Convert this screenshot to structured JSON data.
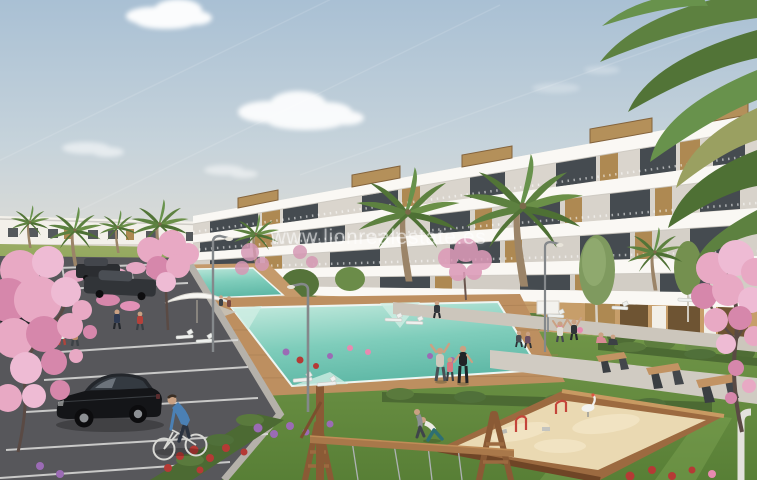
{
  "watermark": {
    "text": "www.lionrealestate.es"
  },
  "scene": {
    "alt": "Architectural render of a modern white terraced apartment complex with wood accents, palm trees, turquoise swimming pools with sun loungers and a parasol, lawns with people exercising, a parking lot with a black hatchback and a cyclist, pink blossoming trees, a wooden sandbox playground and a swing frame."
  },
  "palette": {
    "sky_top": "#a9c0d4",
    "sky_mid": "#c6d3db",
    "sky_horizon": "#e8e0d4",
    "cloud_white": "#ffffff",
    "building_white": "#e9e5dd",
    "slab_white": "#faf8f4",
    "glass_dark": "#454b50",
    "wood_accent": "#ae8952",
    "stucco_tan": "#c79e6a",
    "palm_green": "#5d8140",
    "tree_green": "#6b8c49",
    "lawn_light": "#9aac64",
    "lawn_green": "#6f9447",
    "lawn_dark": "#587f36",
    "hedge_green": "#4c6a33",
    "pool_light": "#c8ece0",
    "pool_turquoise": "#7fcdbb",
    "pool_deep": "#5fb8a6",
    "deck_wood": "#bd8f60",
    "path_grey": "#d0cbc2",
    "asphalt_grey": "#57575b",
    "marking_white": "#dddddc",
    "blossom_pink": "#e8a9c4",
    "blossom_deep": "#d687ab",
    "flower_red": "#b53a35",
    "flower_purple": "#9b6bb5",
    "car_black": "#141518",
    "sand_beige": "#ead9b2",
    "play_wood": "#9c6a40",
    "toy_red": "#c4453a",
    "cyclist_shirt_blue": "#4b80b4"
  }
}
